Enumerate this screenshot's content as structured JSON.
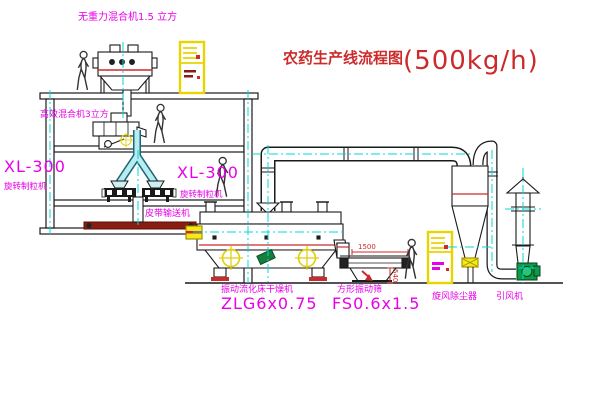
{
  "title": {
    "name": "农药生产线流程图",
    "capacity": "(500kg/h)"
  },
  "equipment": {
    "top_mixer": {
      "label": "无重力混合机1.5 立方"
    },
    "floor2_mixer": {
      "label": "高效混合机3立方"
    },
    "granulator_left": {
      "model": "XL-300",
      "name": "旋转制粒机"
    },
    "granulator_right": {
      "model": "XL-300",
      "name": "旋转制粒机"
    },
    "belt_conveyor": {
      "label": "皮带输送机"
    },
    "dryer": {
      "name": "振动流化床干燥机",
      "model": "ZLG6x0.75"
    },
    "screen": {
      "name": "方形振动筛",
      "model": "FS0.6x1.5",
      "dim_length": "1500",
      "dim_height": "540"
    },
    "cyclone": {
      "label": "旋风除尘器"
    },
    "fan": {
      "label": "引风机"
    }
  },
  "colors": {
    "label_magenta": "#e800e8",
    "title_red": "#cc2b2b",
    "centerline_cyan": "#00d8d8",
    "machine_yellow": "#f0e00a",
    "fan_green": "#0e9a45",
    "line": "#1a1a1a"
  }
}
